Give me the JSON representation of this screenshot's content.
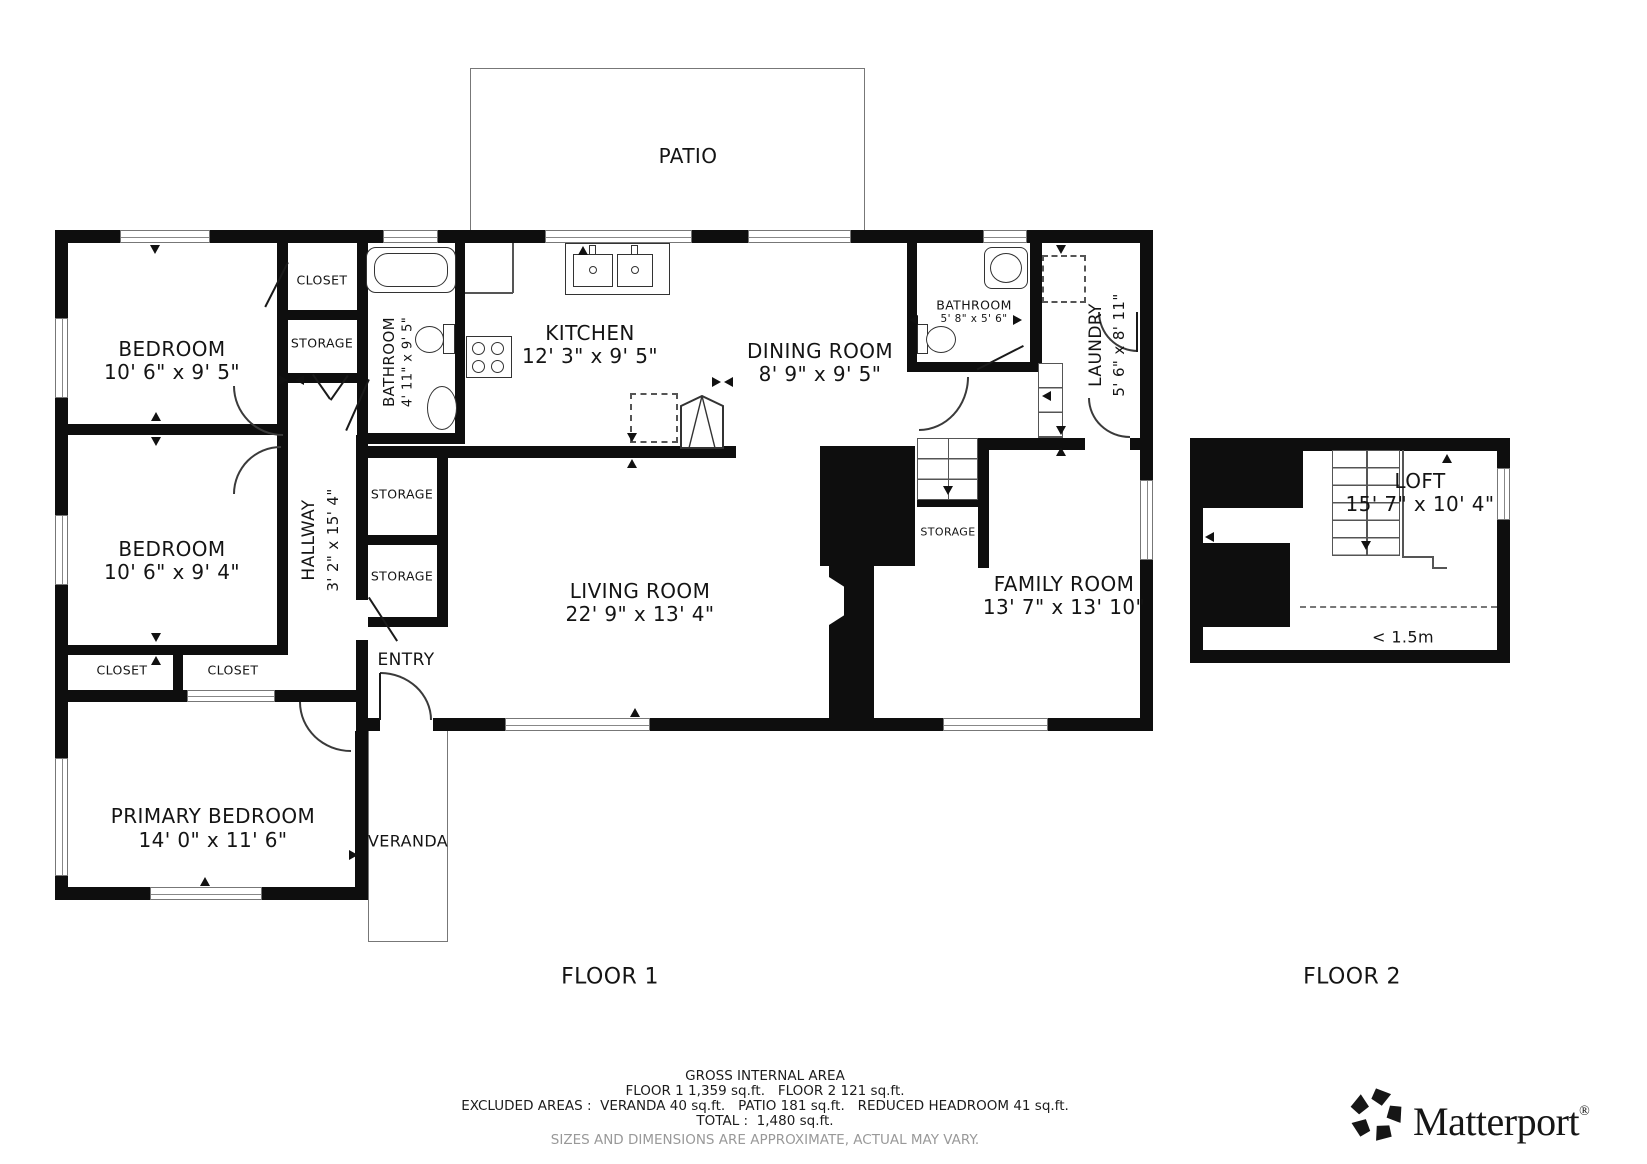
{
  "patio": {
    "label": "PATIO"
  },
  "floor1": {
    "label": "FLOOR 1",
    "rooms": {
      "bedroom_top": {
        "name": "BEDROOM",
        "dims": "10' 6\" x 9' 5\""
      },
      "closet_top": {
        "name": "CLOSET"
      },
      "storage_top": {
        "name": "STORAGE"
      },
      "bathroom_left": {
        "name": "BATHROOM",
        "dims": "4' 11\" x 9' 5\""
      },
      "kitchen": {
        "name": "KITCHEN",
        "dims": "12' 3\" x 9' 5\""
      },
      "dining": {
        "name": "DINING ROOM",
        "dims": "8' 9\" x 9' 5\""
      },
      "bathroom_right": {
        "name": "BATHROOM",
        "dims": "5' 8\" x 5' 6\""
      },
      "laundry": {
        "name": "LAUNDRY",
        "dims": "5' 6\" x 8' 11\""
      },
      "bedroom_mid": {
        "name": "BEDROOM",
        "dims": "10' 6\" x 9' 4\""
      },
      "hallway": {
        "name": "HALLWAY",
        "dims": "3' 2\" x 15' 4\""
      },
      "storage_a": {
        "name": "STORAGE"
      },
      "storage_b": {
        "name": "STORAGE"
      },
      "living": {
        "name": "LIVING ROOM",
        "dims": "22' 9\" x 13' 4\""
      },
      "storage_stairs": {
        "name": "STORAGE"
      },
      "family": {
        "name": "FAMILY ROOM",
        "dims": "13' 7\" x 13' 10\""
      },
      "closet_a": {
        "name": "CLOSET"
      },
      "closet_b": {
        "name": "CLOSET"
      },
      "entry": {
        "name": "ENTRY"
      },
      "primary": {
        "name": "PRIMARY BEDROOM",
        "dims": "14' 0\" x 11' 6\""
      },
      "veranda": {
        "name": "VERANDA"
      }
    }
  },
  "floor2": {
    "label": "FLOOR 2",
    "rooms": {
      "loft": {
        "name": "LOFT",
        "dims": "15' 7\" x 10' 4\""
      }
    },
    "headroom_note": "< 1.5m"
  },
  "footer": {
    "title": "GROSS INTERNAL AREA",
    "line1": "FLOOR 1 1,359 sq.ft.   FLOOR 2 121 sq.ft.",
    "line2": "EXCLUDED AREAS :  VERANDA 40 sq.ft.   PATIO 181 sq.ft.   REDUCED HEADROOM 41 sq.ft.",
    "line3": "TOTAL :  1,480 sq.ft.",
    "disclaimer": "SIZES AND DIMENSIONS ARE APPROXIMATE, ACTUAL MAY VARY."
  },
  "brand": {
    "name": "Matterport",
    "reg": "®"
  }
}
